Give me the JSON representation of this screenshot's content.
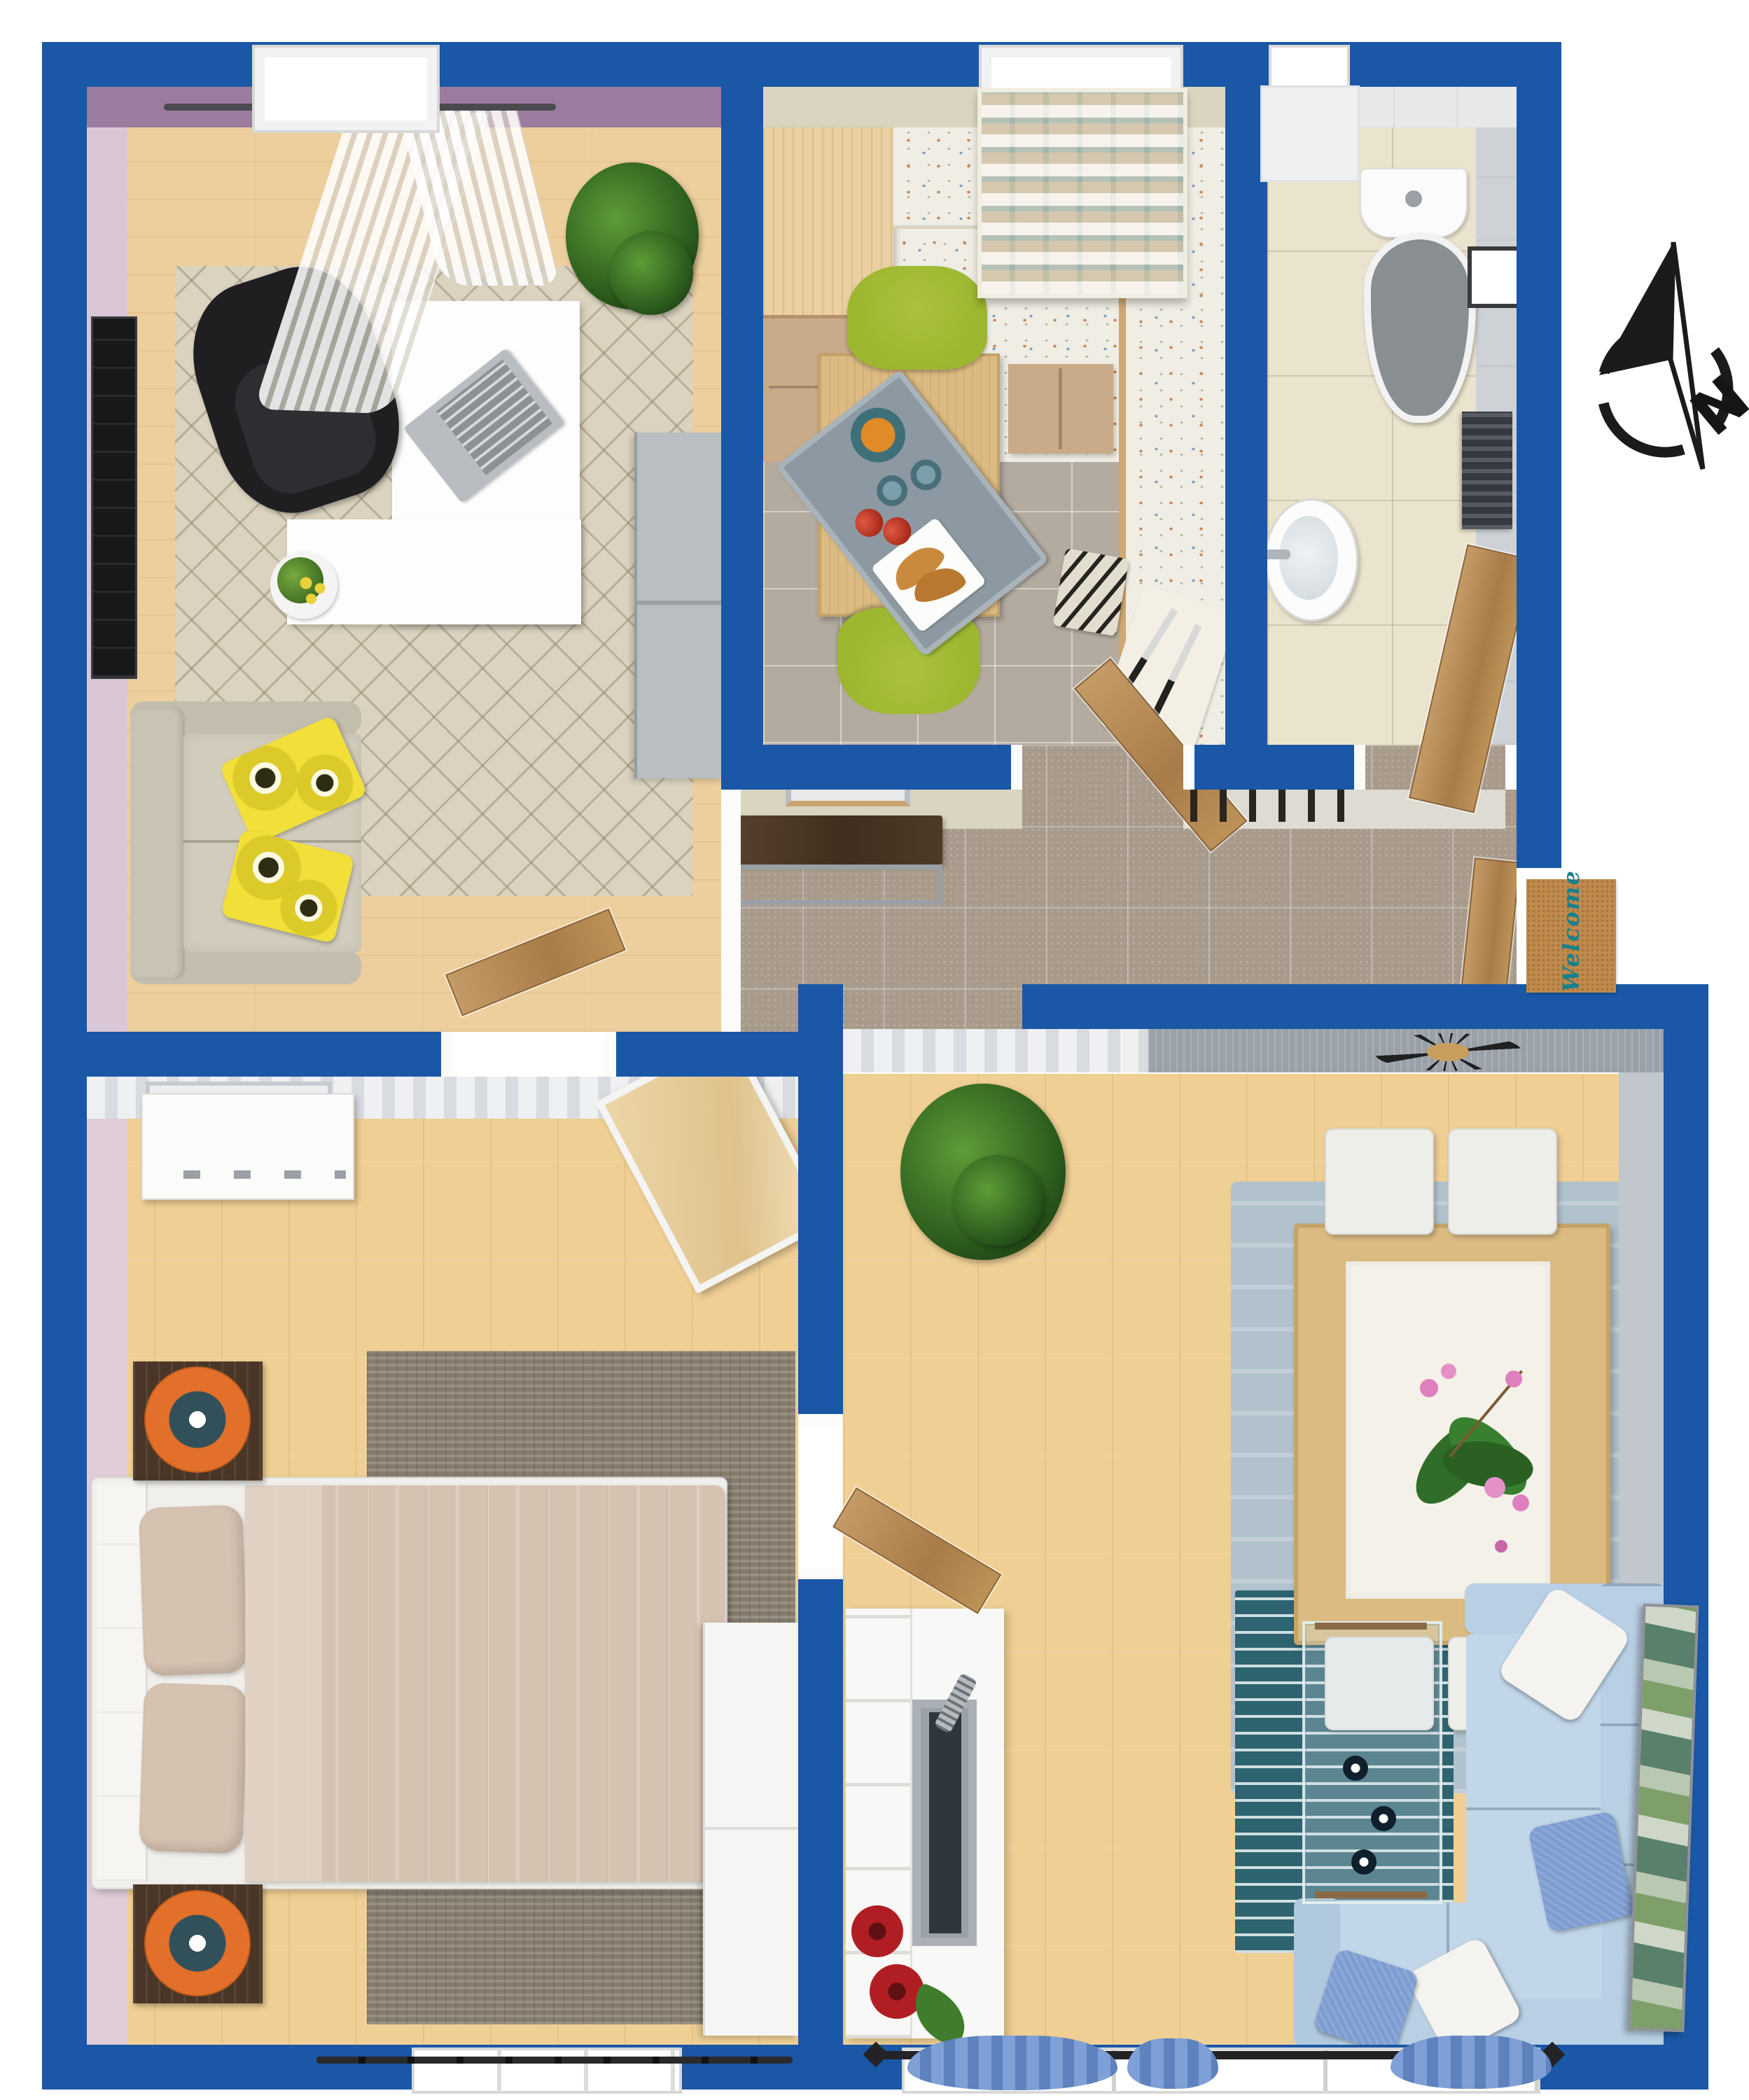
{
  "scene": {
    "kind": "3d-floor-plan-top-view"
  },
  "compass": {
    "label": "N"
  },
  "entrance_mat": {
    "text": "Welcome",
    "text_color": "#17808c",
    "mat_color": "#bf8a4c"
  },
  "palette": {
    "wall_blue": "#1a57a6",
    "office_wall": "#9a7c9e",
    "office_side_wall": "#d9c6d7",
    "kitchen_wall": "#d9d5c0",
    "bath_wall": "#e6e8ea",
    "living_wall_gray": "#9aa1a9",
    "wood_floor_light": "#eccf9d",
    "wood_floor_warm": "#efcf94",
    "kitchen_tile": "#b4aba0",
    "bath_tile": "#eae3cd",
    "hall_tile": "#a89b8c",
    "office_rug": "#dbd3bf",
    "bedroom_rug": "#857c6d",
    "dining_rug": "#b2c2cd",
    "living_rug_teal": "#2e6370",
    "sofa_office": "#d2ccbd",
    "pillow_yellow": "#f2df3a",
    "sofa_living": "#c1d6e8",
    "pillow_blue": "#7d9cd1",
    "bed_linen": "#d6c2b1",
    "nightstand_wood": "#4a3626",
    "lamp_orange": "#e2702a",
    "kitchen_cabinet_wood": "#ead0a2",
    "kitchen_cabinet_front": "#c9ab89",
    "counter_terrazzo": "#f0ede4",
    "chair_green": "#9db62f",
    "table_wood": "#dcbb82",
    "door_wood": "#b78f5d",
    "furniture_white": "#f8f8f6",
    "accent_red": "#b01e23",
    "plant_green": "#3f7d2c",
    "mat_text": "#17808c"
  },
  "rooms": [
    {
      "id": "office"
    },
    {
      "id": "kitchen"
    },
    {
      "id": "bathroom"
    },
    {
      "id": "hallway"
    },
    {
      "id": "bedroom"
    },
    {
      "id": "living-dining-room"
    }
  ]
}
